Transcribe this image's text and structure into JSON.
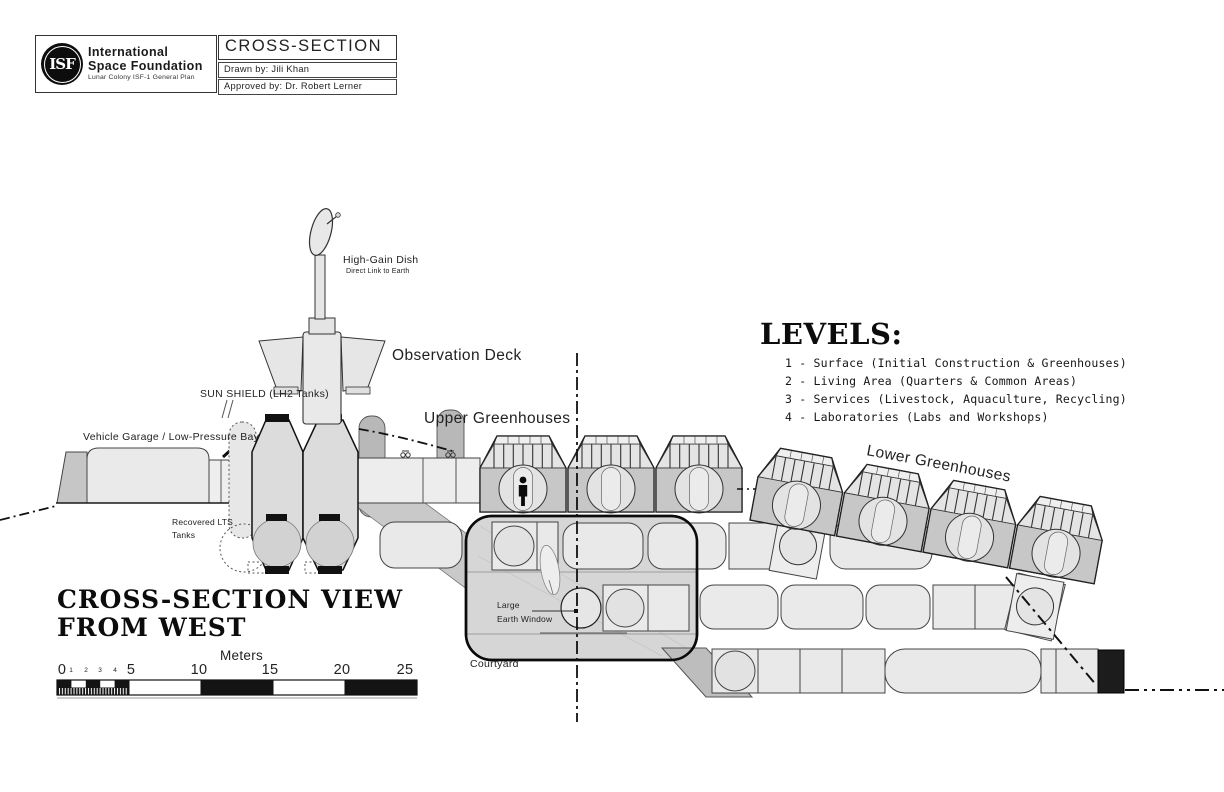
{
  "title_block": {
    "logo_text": "ISF",
    "org_name_line1": "International",
    "org_name_line2": "Space Foundation",
    "org_subtitle": "Lunar Colony ISF-1 General Plan",
    "sheet_title": "CROSS-SECTION",
    "drawn_by": "Drawn by: Jili Khan",
    "approved_by": "Approved by: Dr. Robert Lerner"
  },
  "legend": {
    "title": "LEVELS:",
    "items": [
      "1 - Surface (Initial Construction & Greenhouses)",
      "2 - Living Area (Quarters & Common Areas)",
      "3 - Services (Livestock, Aquaculture, Recycling)",
      "4 - Laboratories (Labs and Workshops)"
    ]
  },
  "annotations": {
    "high_gain_dish": "High-Gain Dish",
    "high_gain_dish_sub": "Direct Link to Earth",
    "observation_deck": "Observation Deck",
    "sun_shield": "SUN SHIELD (LH2 Tanks)",
    "upper_greenhouses": "Upper Greenhouses",
    "vehicle_garage": "Vehicle Garage / Low-Pressure Bay",
    "recovered_tanks_line1": "Recovered LTS",
    "recovered_tanks_line2": "Tanks",
    "lower_greenhouses": "Lower Greenhouses",
    "earth_window_line1": "Large",
    "earth_window_line2": "Earth Window",
    "courtyard": "Courtyard"
  },
  "view_title": {
    "line1": "CROSS-SECTION VIEW",
    "line2": "FROM WEST"
  },
  "scale_bar": {
    "unit_label": "Meters",
    "major_ticks": [
      "0",
      "5",
      "10",
      "15",
      "20",
      "25"
    ],
    "minor_ticks": [
      "1",
      "2",
      "3",
      "4"
    ]
  },
  "colors": {
    "paper": "#ffffff",
    "ink": "#111111",
    "fill_light": "#ececec",
    "fill_mid": "#d6d6d6",
    "fill_dark": "#c2c2c2",
    "fill_shadow": "#b5b5b5"
  }
}
